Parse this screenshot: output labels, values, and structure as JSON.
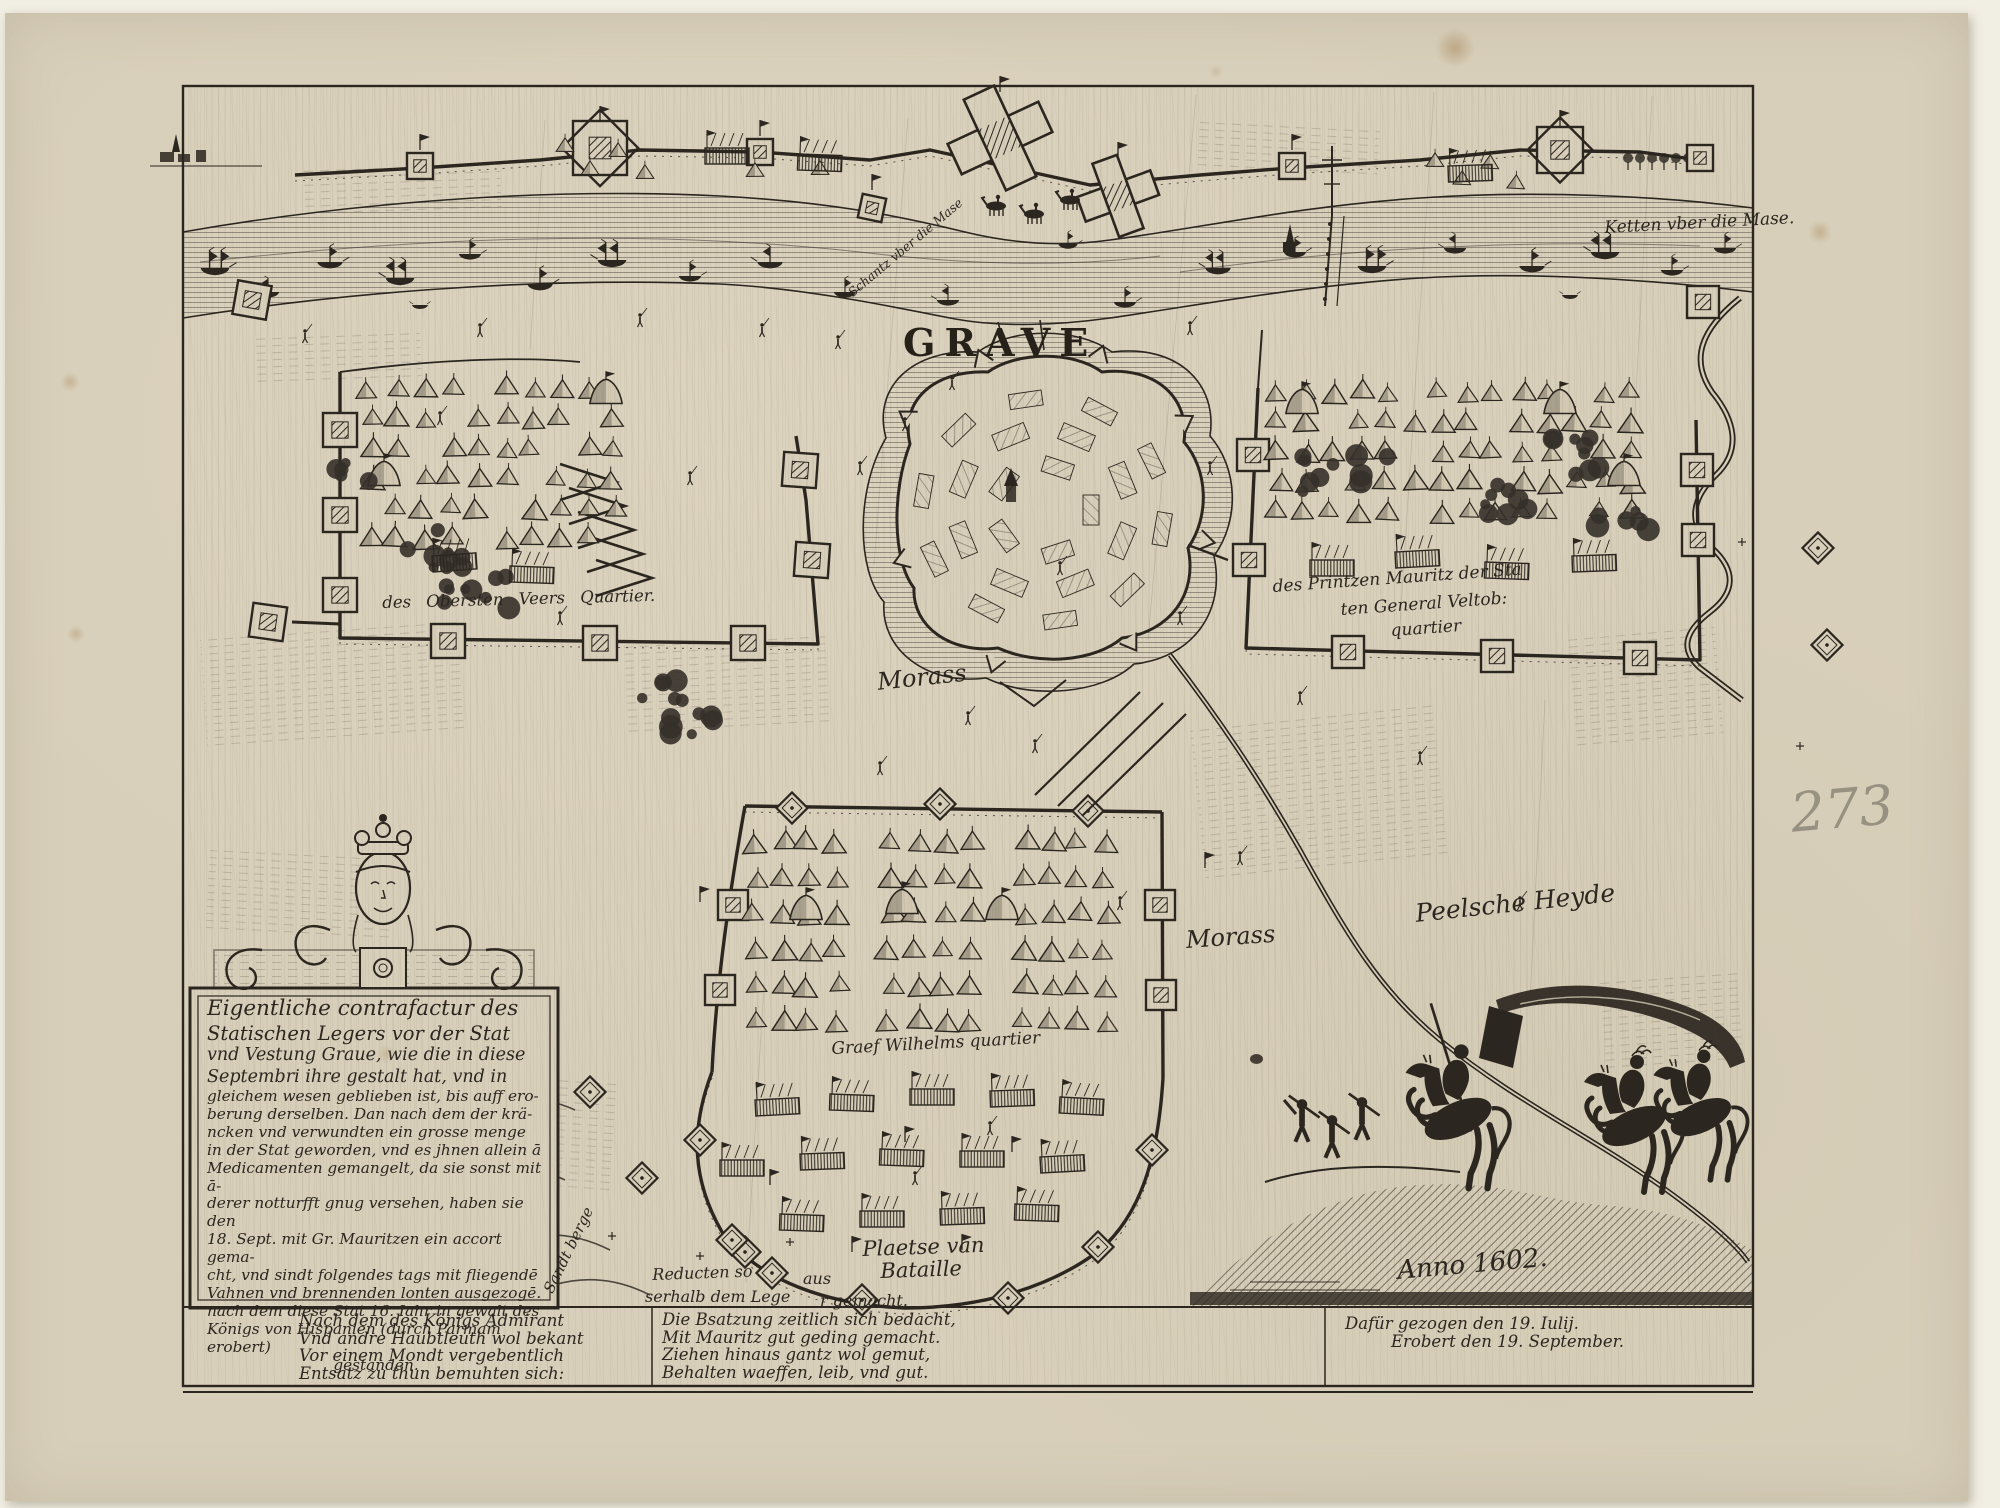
{
  "colors": {
    "ink": "#2b261f",
    "paper": "#d8cfba",
    "backing": "#f1eee3",
    "pencil": "#8d8779"
  },
  "page": {
    "handwritten_number": "273"
  },
  "map": {
    "title": "GRAVE",
    "labels": {
      "chain": "Ketten vber die Mase.",
      "sconce": "Schantz vber die Mase",
      "left_camp": "des Obersten Veers Quartier.",
      "right_camp_l1": "des Printzen Mauritz der Sta",
      "right_camp_l2": "ten General Veltob:",
      "right_camp_l3": "quartier",
      "bottom_camp": "Graef Wilhelms quartier",
      "morass_west": "Morass",
      "morass_east": "Morass",
      "heath": "Peelsche Heyde",
      "battlefield_l1": "Plaetse van",
      "battlefield_l2": "Bataille",
      "redoubts_l1a": "Reducten so",
      "redoubts_l1b": "aus",
      "redoubts_l2a": "serhalb dem Lege",
      "redoubts_l2b": "r gemacht.",
      "sand_hills": "Sandt berge",
      "anno": "Anno 1602."
    },
    "cartouche": {
      "lines": [
        "Eigentliche contrafactur des",
        "Statischen Legers vor der Stat",
        "vnd Vestung Graue, wie die in diese",
        "Septembri ihre gestalt hat, vnd in",
        "gleichem wesen geblieben ist, bis auff ero-",
        "berung derselben. Dan nach dem der krä-",
        "ncken vnd verwundten ein grosse menge",
        "in der Stat geworden, vnd es jhnen allein ā",
        "Medicamenten gemangelt, da sie sonst mit ā-",
        "derer notturfft gnug versehen, haben sie den",
        "18. Sept. mit Gr. Mauritzen ein accort gema-",
        "cht, vnd sindt folgendes tags mit fliegendē",
        "Vahnen vnd brennenden lonten ausgezogē.",
        "nach dem diese Stat 16. Iahr in gewalt des",
        "Königs von Hispanien (durch Parmam erobert)",
        "gestanden."
      ]
    },
    "verses": {
      "left": [
        "Nach dem des Königs Admirant",
        "Vnd andre Haubtleuth wol bekant",
        "Vor einem Mondt vergebentlich",
        "Entsatz zu thun bemuhten sich:"
      ],
      "middle": [
        "Die Bsatzung zeitlich sich bedacht,",
        "Mit Mauritz gut geding gemacht.",
        "Ziehen hinaus gantz wol gemut,",
        "Behalten waeffen, leib, vnd gut."
      ],
      "right": [
        "Dafür gezogen den 19. Iulij.",
        "Erobert den 19. September."
      ]
    }
  }
}
